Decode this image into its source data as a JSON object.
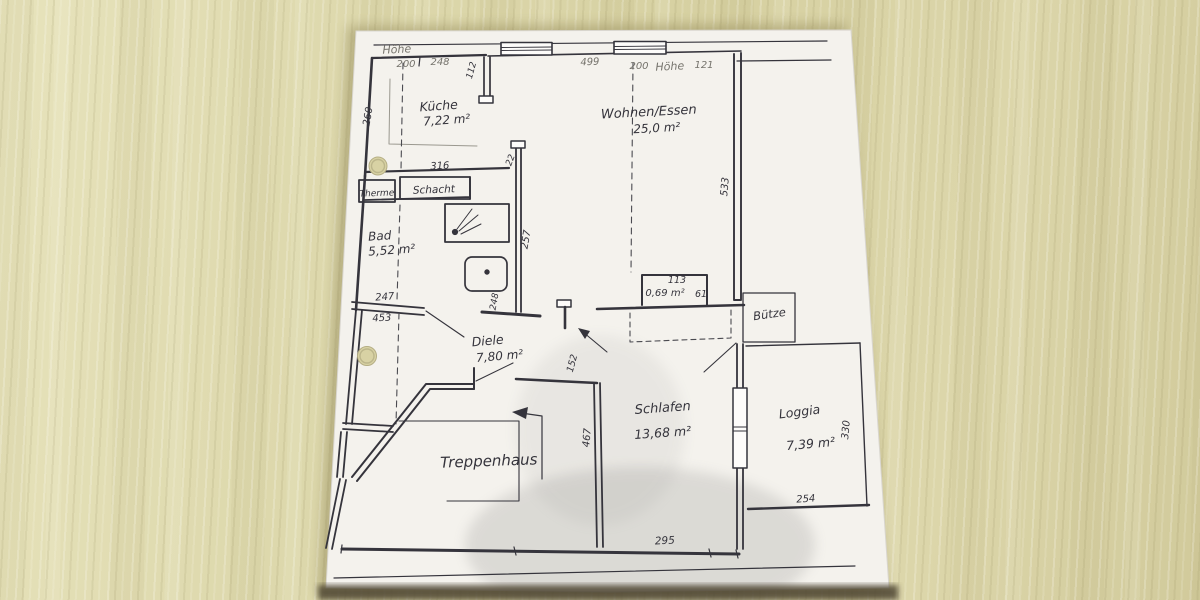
{
  "colors": {
    "wood": "#d9d3a6",
    "paper": "#f4f2ed",
    "ink": "#35343c",
    "pencil": "#75736c",
    "shadow": "#4e4430"
  },
  "rooms": {
    "kueche": {
      "name": "Küche",
      "area": "7,22 m²"
    },
    "wohnen_essen": {
      "name": "Wohnen/Essen",
      "area": "25,0 m²"
    },
    "bad": {
      "name": "Bad",
      "area": "5,52 m²"
    },
    "diele": {
      "name": "Diele",
      "area": "7,80 m²"
    },
    "schlafen": {
      "name": "Schlafen",
      "area": "13,68 m²"
    },
    "loggia": {
      "name": "Loggia",
      "area": "7,39 m²"
    },
    "treppenhaus": {
      "name": "Treppenhaus"
    },
    "abstellraum": {
      "area": "0,69 m²"
    },
    "buetze": {
      "name": "Bütze"
    },
    "therme": {
      "name": "Therme"
    },
    "schacht": {
      "name": "Schacht"
    }
  },
  "dimensions": {
    "hoehe_left": "Höhe",
    "d200_top_left": "200",
    "d248_top": "248",
    "d112": "112",
    "d499": "499",
    "d200_top_right": "200",
    "hoehe_right": "Höhe",
    "d121": "121",
    "d260": "260",
    "d316": "316",
    "d22": "22",
    "d533": "533",
    "d257": "257",
    "d248_wall": "248",
    "d247": "247",
    "d453": "453",
    "d113": "113",
    "d61": "61",
    "d152": "152",
    "d467": "467",
    "d330": "330",
    "d254": "254",
    "d295": "295"
  }
}
